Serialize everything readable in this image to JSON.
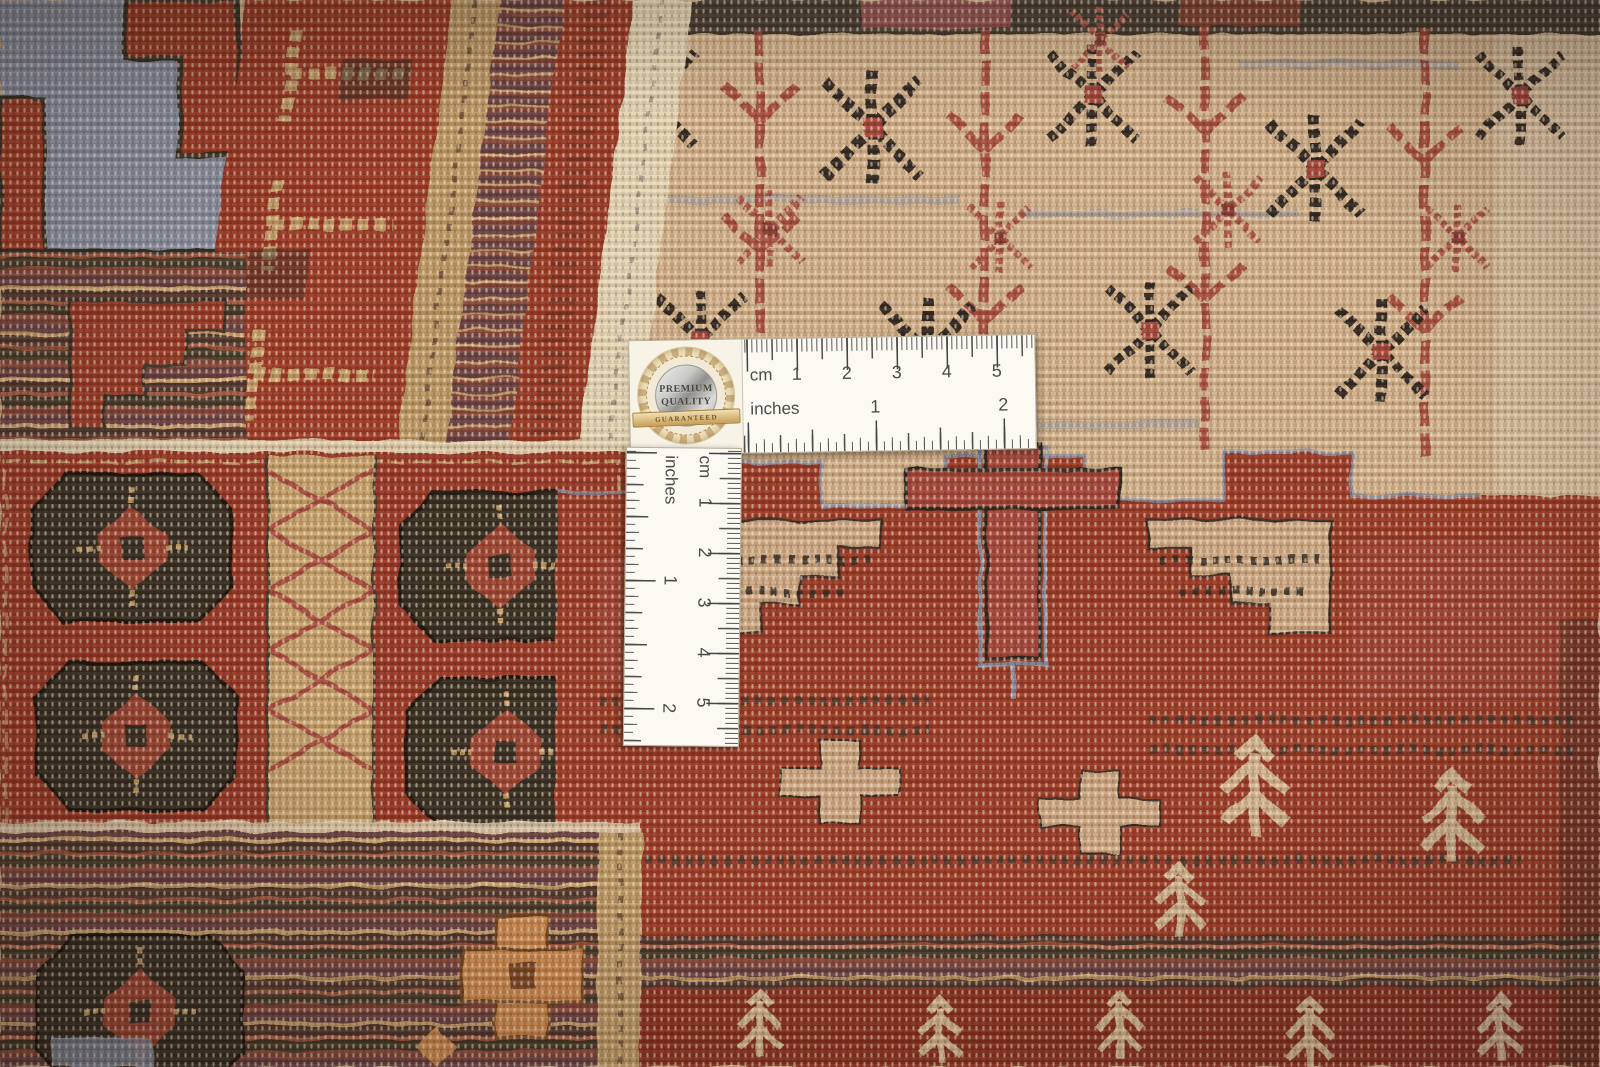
{
  "rulers": {
    "horizontal": {
      "cm_label": "cm",
      "inches_label": "inches",
      "cm_numbers": [
        "1",
        "2",
        "3",
        "4",
        "5"
      ],
      "inches_numbers": [
        "1",
        "2"
      ]
    },
    "vertical": {
      "cm_label": "cm",
      "inches_label": "inches",
      "cm_numbers": [
        "1",
        "2",
        "3",
        "4",
        "5"
      ],
      "inches_numbers": [
        "1",
        "2"
      ]
    }
  },
  "badge": {
    "premium": "PREMIUM",
    "quality": "QUALITY",
    "guaranteed": "GUARANTEED"
  },
  "colors": {
    "rug_red": "#9e3a28",
    "rug_dark_brown": "#362c21",
    "rug_beige": "#d4b28b",
    "rug_cream": "#e7d6b4",
    "rug_blue_gray": "#8d93a6",
    "rug_maroon": "#6d4242",
    "rug_tan": "#c09a66",
    "rug_rose": "#b0584a",
    "rug_orange": "#d08a4f",
    "ruler_white": "#fbf9f2",
    "tick_gray": "#4c4c4c",
    "seal_gold": "#c89f58",
    "seal_silver": "#b5b5b2"
  }
}
